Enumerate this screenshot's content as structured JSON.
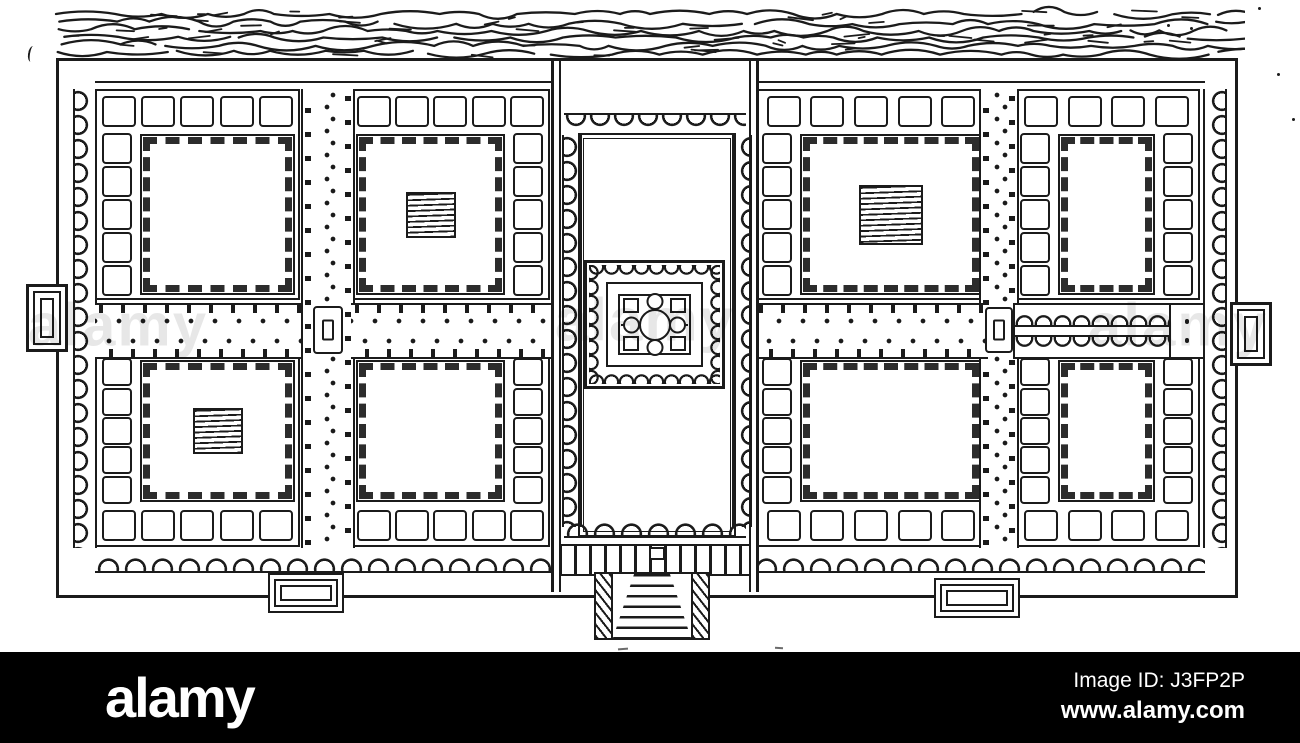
{
  "canvas": {
    "width": 1300,
    "height": 743,
    "background": "#ffffff"
  },
  "colors": {
    "ink": "#1b1b1b",
    "paper": "#ffffff",
    "bar_background": "#000000",
    "bar_text": "#ffffff"
  },
  "artwork": {
    "type": "scanned line drawing",
    "subject": "plan of a walled formal garden (charbagh) beside a river, with central pavilion court, planting plots, water channel, gates and entrance stairs"
  },
  "plan": {
    "squares_per_row": 5,
    "squares_per_column": 5,
    "plots": [
      {
        "id": "plot-top-left",
        "position": "top row, outer left",
        "border_squares": [
          "top",
          "left"
        ],
        "water_tank": false
      },
      {
        "id": "plot-top-left-inner",
        "position": "top row, inner left",
        "border_squares": [
          "top",
          "right"
        ],
        "water_tank": true
      },
      {
        "id": "plot-top-right-inner",
        "position": "top row, inner right",
        "border_squares": [
          "top",
          "left"
        ],
        "water_tank": true
      },
      {
        "id": "plot-top-right",
        "position": "top row, outer right",
        "border_squares": [
          "top",
          "left",
          "right"
        ],
        "water_tank": false
      },
      {
        "id": "plot-bottom-left",
        "position": "bottom row, outer left",
        "border_squares": [
          "bottom",
          "left"
        ],
        "water_tank": true
      },
      {
        "id": "plot-bottom-left-inner",
        "position": "bottom row, inner left",
        "border_squares": [
          "bottom",
          "right"
        ],
        "water_tank": false
      },
      {
        "id": "plot-bottom-right-inner",
        "position": "bottom row, inner right",
        "border_squares": [
          "bottom",
          "left"
        ],
        "water_tank": false
      },
      {
        "id": "plot-bottom-right",
        "position": "bottom row, outer right",
        "border_squares": [
          "bottom",
          "left",
          "right"
        ],
        "water_tank": false
      }
    ]
  },
  "watermark_bar": {
    "logo_text": "alamy",
    "image_id_text": "Image ID: J3FP2P",
    "url_text": "www.alamy.com"
  },
  "faint_watermark_text": "alamy"
}
